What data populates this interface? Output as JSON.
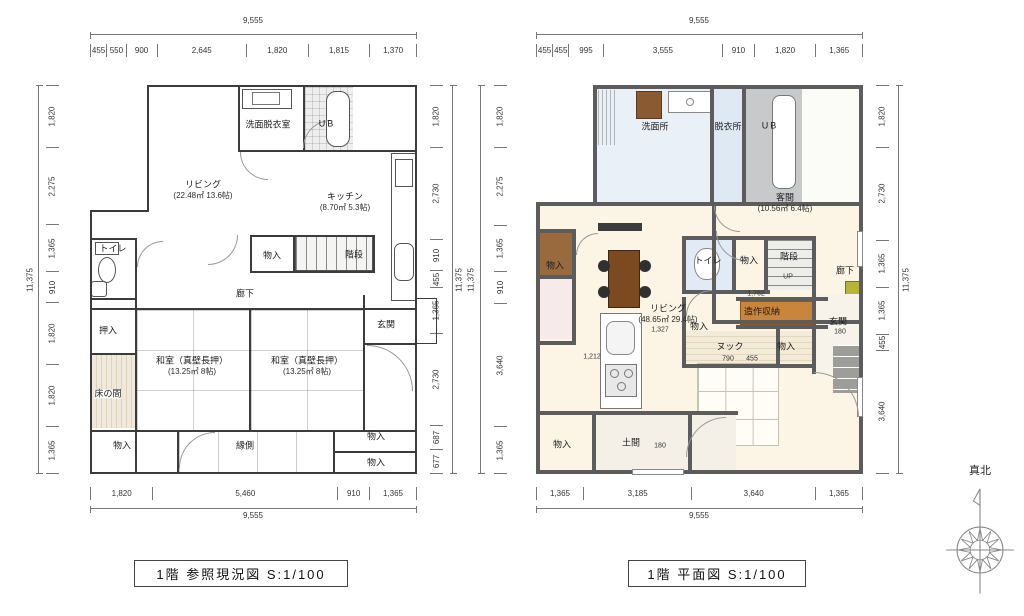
{
  "captions": {
    "left": "1階 参照現況図 S:1/100",
    "right": "1階 平面図 S:1/100"
  },
  "compass": {
    "label": "真北"
  },
  "left_plan": {
    "dims": {
      "top_total": "9,555",
      "top": [
        "455",
        "550",
        "900",
        "2,645",
        "1,820",
        "1,815",
        "1,370"
      ],
      "bottom": [
        "1,820",
        "5,460",
        "910",
        "1,365"
      ],
      "bottom_total": "9,555",
      "left": [
        "1,820",
        "2,275",
        "1,365",
        "910",
        "1,820",
        "1,820",
        "1,365"
      ],
      "left_total": "11,375",
      "right": [
        "1,820",
        "2,730",
        "910",
        "455",
        "1,365",
        "2,730",
        "687",
        "677"
      ],
      "right_total": "11,375"
    },
    "rooms": {
      "senmen": "洗面脱衣室",
      "ub": "UB",
      "living": "リビング",
      "living_area": "(22.48㎡ 13.6帖)",
      "kitchen": "キッチン",
      "kitchen_area": "(8.70㎡ 5.3帖)",
      "toilet": "トイレ",
      "monoire_mid": "物入",
      "kaidan": "階段",
      "rouka": "廊下",
      "genkan": "玄関",
      "oshiire": "押入",
      "washitsu": "和室（真壁長押）",
      "washitsu_area": "(13.25㎡ 8帖)",
      "tokonoma": "床の間",
      "monoire_sw": "物入",
      "engawa": "縁側",
      "monoire_e1": "物入",
      "monoire_e2": "物入"
    }
  },
  "right_plan": {
    "dims": {
      "top_total": "9,555",
      "top": [
        "455",
        "455",
        "995",
        "3,555",
        "910",
        "1,820",
        "1,365"
      ],
      "bottom": [
        "1,365",
        "3,185",
        "3,640",
        "1,365"
      ],
      "bottom_total": "9,555",
      "left": [
        "1,820",
        "2,275",
        "1,365",
        "910",
        "3,640",
        "1,365"
      ],
      "left_total": "11,375",
      "right": [
        "1,820",
        "2,730",
        "1,365",
        "1,365",
        "455",
        "3,640"
      ],
      "right_total": "11,375"
    },
    "rooms": {
      "senmenjo": "洗面所",
      "datsuijo": "脱衣所",
      "ub": "UB",
      "kyakuma": "客間",
      "kyakuma_area": "(10.56㎡ 6.4帖)",
      "monoire_w": "物入",
      "toilet": "トイレ",
      "monoire_mid": "物入",
      "kaidan": "階段",
      "up": "UP",
      "rouka": "廊下",
      "living": "リビング",
      "living_area": "(48.65㎡ 29.4帖)",
      "zousaku": "造作収納",
      "genkan": "玄関",
      "genkan_dim": "180",
      "monoire_c": "物入",
      "nook": "ヌック",
      "monoire_n": "物入",
      "doma": "土間",
      "doma_dim": "180",
      "monoire_s": "物入",
      "dim_1762": "1,762",
      "dim_1212": "1,212",
      "dim_1327": "1,327",
      "dim_790": "790",
      "dim_455": "455"
    }
  }
}
